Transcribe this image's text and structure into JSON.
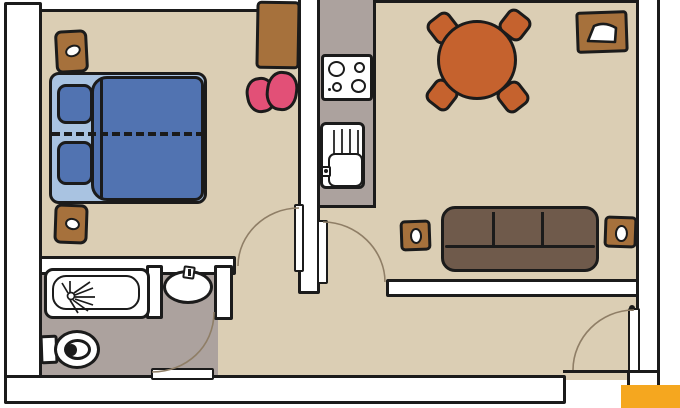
{
  "title": "hand-drawn apartment floor plan",
  "palette": {
    "page_bg": "#ffffff",
    "outline": "#1b1b1b",
    "wall_fill": "#ffffff",
    "floor_beige": "#dbceb4",
    "wet_floor_gray": "#aca29e",
    "bed_blanket_blue": "#5173b1",
    "bed_sheet_blue": "#a9c3e1",
    "wood_brown": "#a6713c",
    "sofa_brown": "#6f5a4b",
    "table_orange": "#c5622e",
    "pouf_pink": "#e25077",
    "brand_orange": "#f5a71f",
    "appliance_white": "#ffffff",
    "arc_line": "#8f7e66",
    "drainer_line": "#3a3a3a"
  },
  "rooms": {
    "bedroom": [
      "double-bed",
      "nightstand-top",
      "nightstand-bottom",
      "dresser",
      "pouf"
    ],
    "kitchen": [
      "stove-four-burners",
      "sink-with-drainer"
    ],
    "dining": [
      "round-table",
      "chair-top-left",
      "chair-top-right",
      "chair-bottom-left",
      "chair-bottom-right",
      "pet-bowl"
    ],
    "living": [
      "three-seat-sofa",
      "side-table-lamp-left",
      "side-table-lamp-right"
    ],
    "bathroom": [
      "bathtub-with-shower",
      "washbasin",
      "toilet"
    ]
  },
  "doors": [
    "bedroom-door",
    "hall-living-door",
    "bathroom-door",
    "entry-door"
  ],
  "bed": {
    "pillows": 2,
    "dashed_center_line": true
  },
  "stove": {
    "burners": 4
  },
  "sofa": {
    "seats": 3
  }
}
